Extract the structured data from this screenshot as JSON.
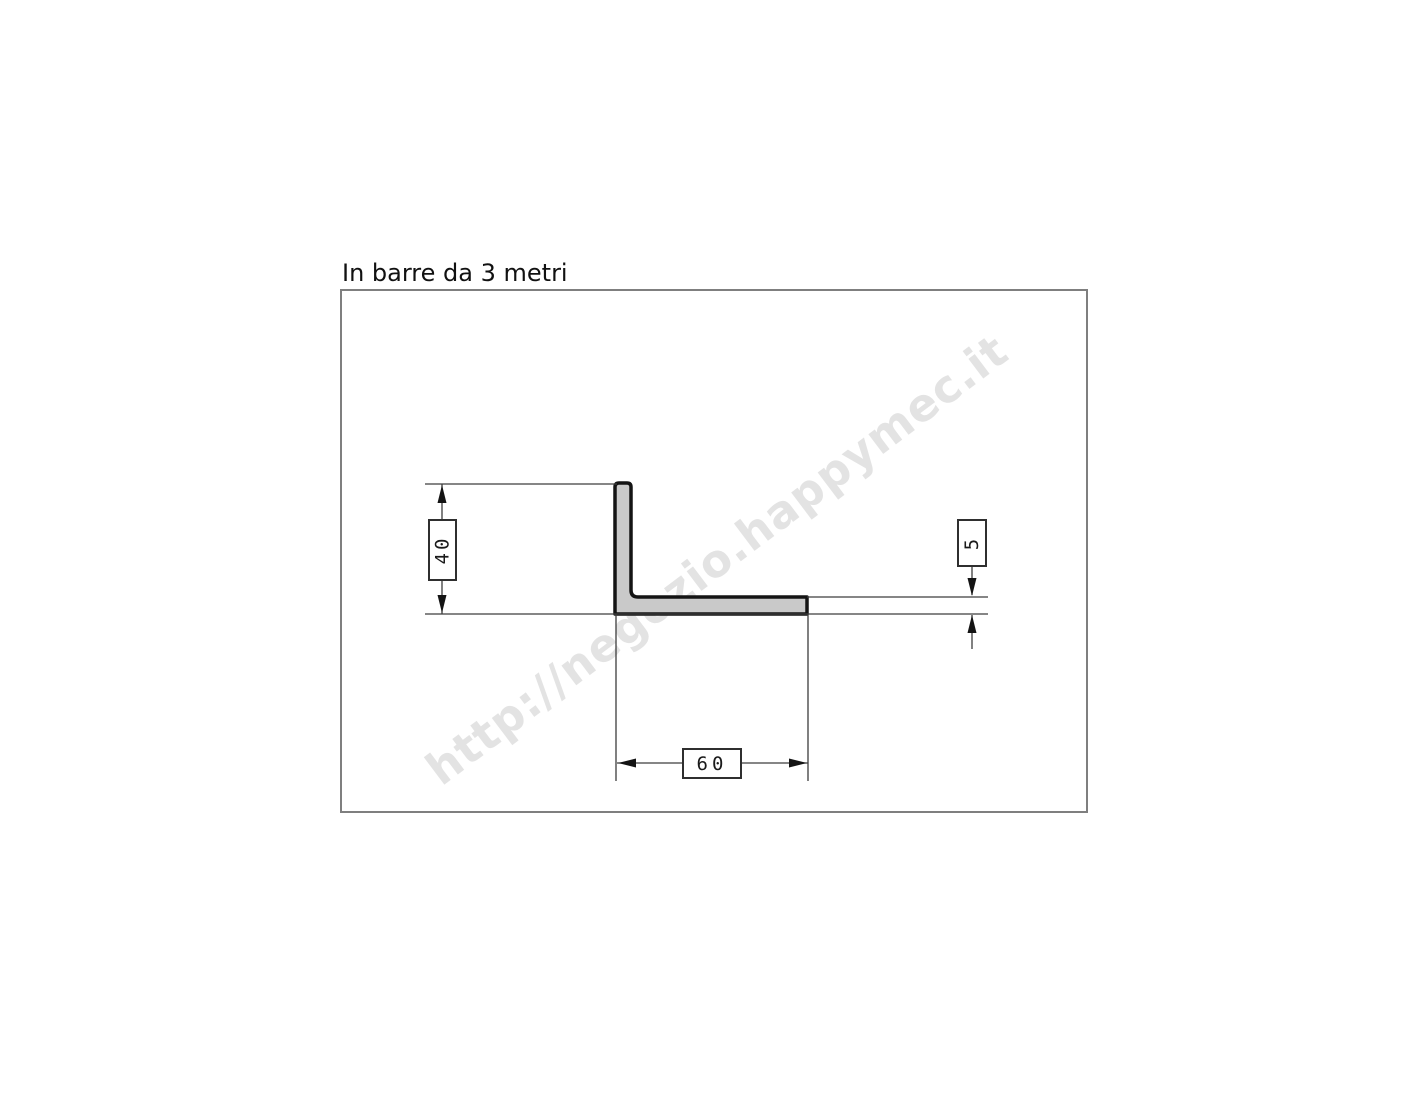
{
  "title": "In barre da 3 metri",
  "watermark": {
    "text": "http://negozio.happymec.it",
    "color": "#e3e3e3",
    "angle_deg": -37
  },
  "drawing": {
    "type": "technical-section",
    "profile": {
      "shape": "L-angle-profile",
      "fill_color": "#c9c9c9",
      "outline_color": "#141414"
    },
    "dimensions": [
      {
        "id": "height",
        "value": "40",
        "orientation": "vertical",
        "unit": "mm"
      },
      {
        "id": "width",
        "value": "60",
        "orientation": "horizontal",
        "unit": "mm"
      },
      {
        "id": "thickness",
        "value": "5",
        "orientation": "vertical",
        "unit": "mm"
      }
    ],
    "line_color": "#3d3d3d",
    "frame_color": "#7f7f7f"
  }
}
